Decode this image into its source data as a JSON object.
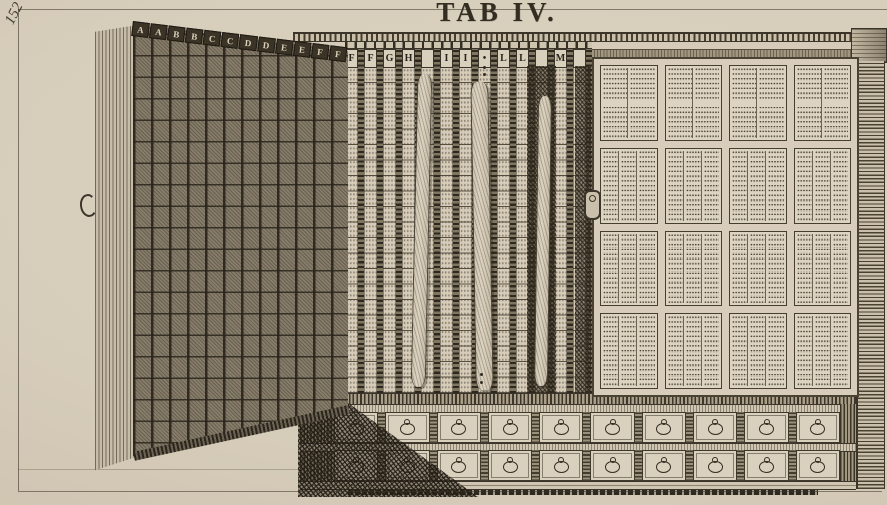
{
  "plate": {
    "title": "TAB IV.",
    "page_number": "152"
  },
  "palette": {
    "paper": "#d7cdbb",
    "paper_light": "#ded4c2",
    "paper_dark": "#cdc2ae",
    "ink": "#332d22",
    "ink_mid": "#4a4334",
    "wood_shadow": "#2b261d",
    "door_fill": "#877d6a"
  },
  "door": {
    "letters": [
      "A",
      "A",
      "B",
      "B",
      "C",
      "C",
      "D",
      "D",
      "E",
      "E",
      "F",
      "F"
    ],
    "handle": "C-shaped ring handle"
  },
  "middle_section": {
    "column_letters": [
      "F",
      "F",
      "G",
      "H",
      "",
      "I",
      "I",
      "•",
      "L",
      "L",
      "",
      "M",
      ""
    ],
    "hanging_strips": 3,
    "dot_symbol": "•"
  },
  "right_panel": {
    "grid_rows": 4,
    "grid_cols": 4,
    "text_columns_per_row": [
      2,
      3,
      3,
      3
    ],
    "hardware": "keyhole escutcheon"
  },
  "base": {
    "drawer_rows": 2,
    "drawers_per_row": 10,
    "pull": "ring pull"
  }
}
